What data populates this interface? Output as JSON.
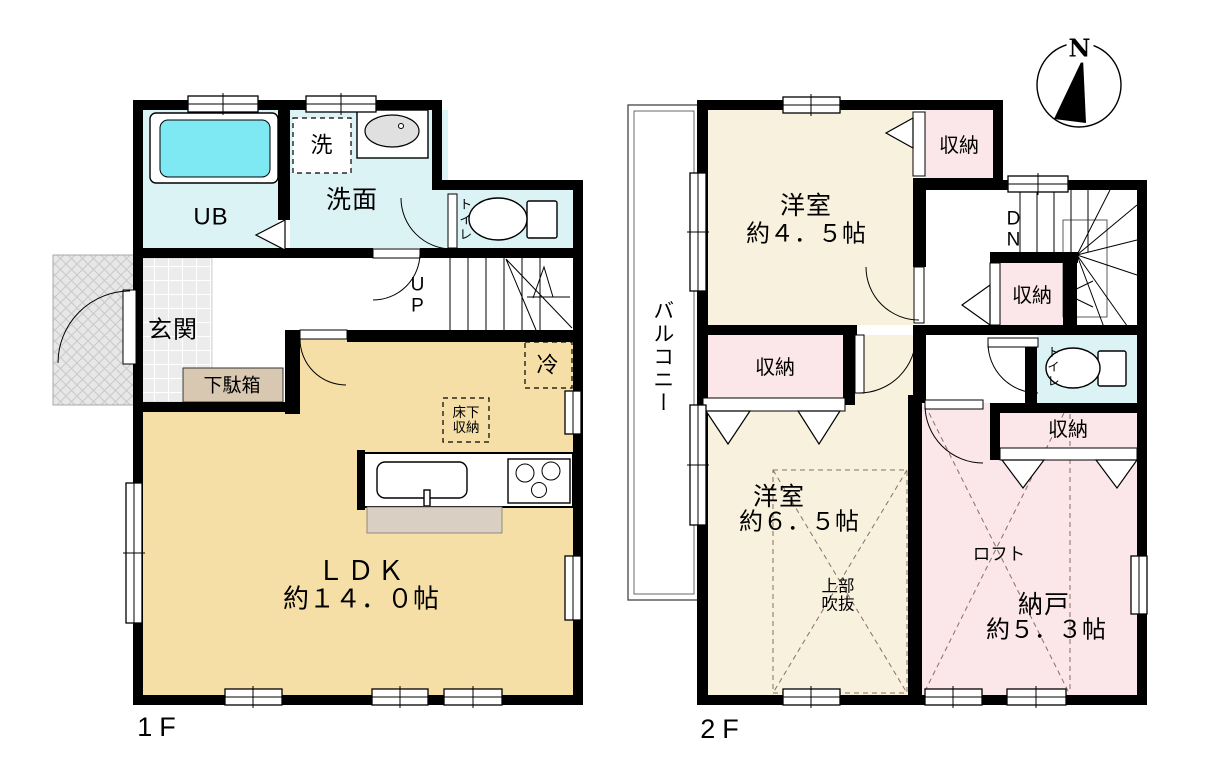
{
  "compass": {
    "north_label": "N"
  },
  "floor1": {
    "floor_label": "1F",
    "rooms": {
      "ub": "UB",
      "washer": "洗",
      "washroom": "洗面",
      "toilet": "トイレ",
      "entrance": "玄関",
      "shoe_box": "下駄箱",
      "stairs_up": "U\nP",
      "ldk_name": "ＬＤＫ",
      "ldk_size": "約１４．０帖",
      "fridge": "冷",
      "underfloor_storage": "床下\n収納"
    }
  },
  "floor2": {
    "floor_label": "2F",
    "rooms": {
      "balcony": "バルコニー",
      "room_a_name": "洋室",
      "room_a_size": "約４．５帖",
      "room_b_name": "洋室",
      "room_b_size": "約６．５帖",
      "storage_room_name": "納戸",
      "storage_room_size": "約５．３帖",
      "closet_a": "収納",
      "closet_b": "収納",
      "closet_c": "収納",
      "closet_d": "収納",
      "stairs_down": "D\nN",
      "toilet": "トイレ",
      "loft": "ロフト",
      "open_ceiling": "上部\n吹抜"
    }
  },
  "colors": {
    "wall": "#000000",
    "cream": "#f8f1de",
    "wheat": "#f6dfa6",
    "pink": "#fbe6e9",
    "cyan": "#dcf3f6",
    "bathtub": "#7ee9f2",
    "tile": "#ececec",
    "porch": "#e7e7e7",
    "island": "#d9cfc2",
    "shoebox": "#d8c8b2",
    "sinkgray": "#e0e0e0"
  }
}
